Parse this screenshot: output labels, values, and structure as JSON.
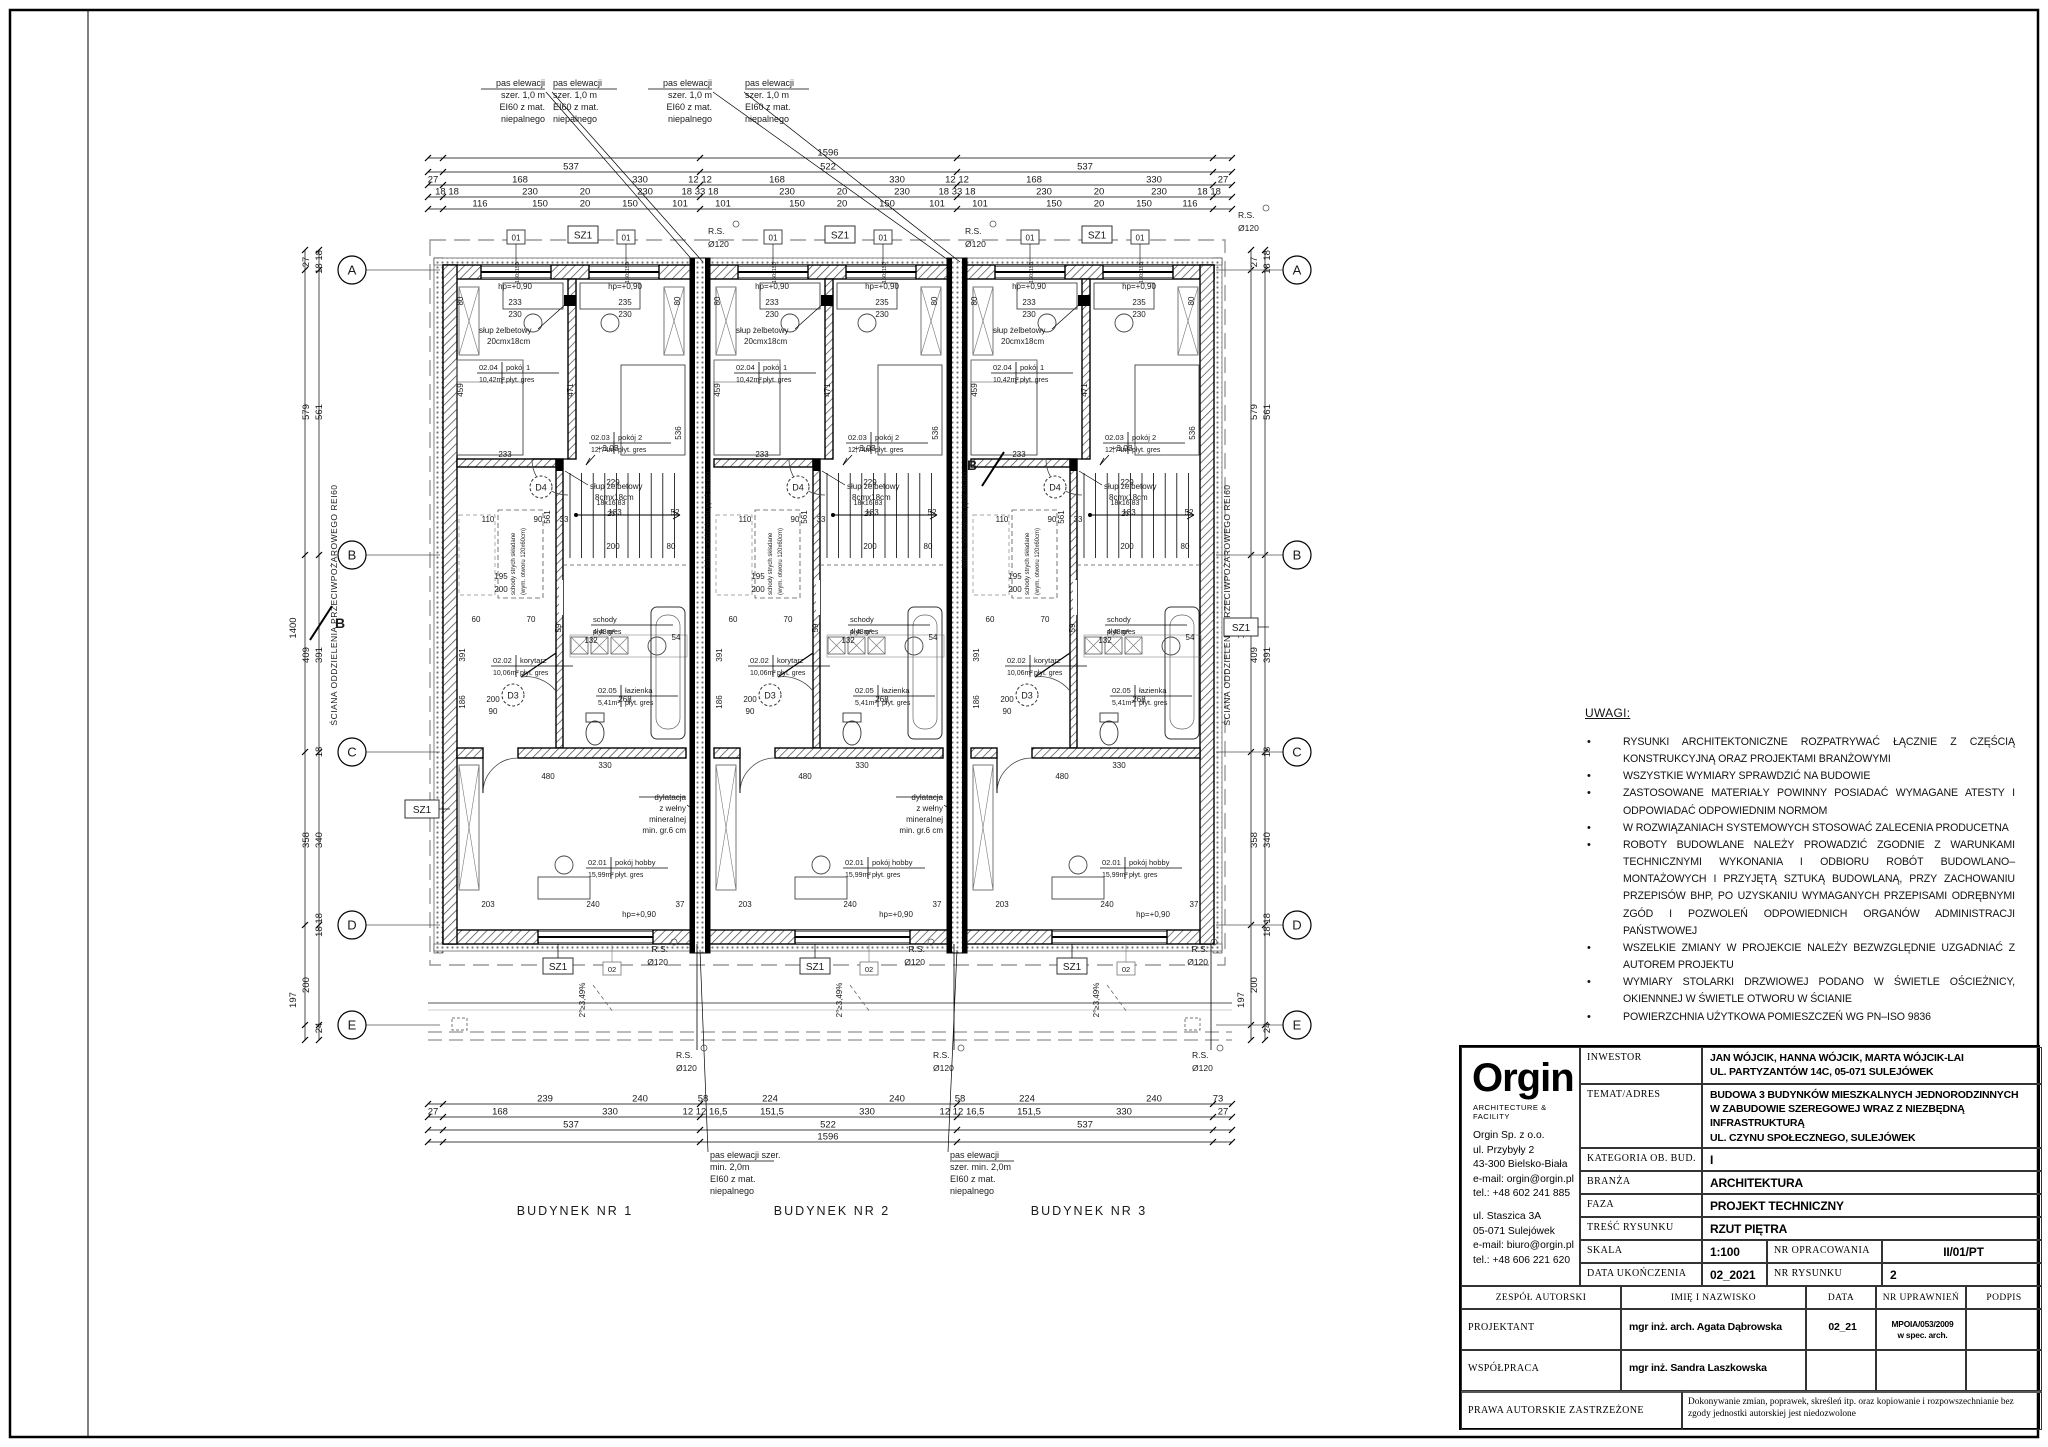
{
  "sheet": {
    "width": 2048,
    "height": 1447
  },
  "plan": {
    "buildings": [
      "BUDYNEK NR 1",
      "BUDYNEK NR 2",
      "BUDYNEK NR 3"
    ],
    "grid_rows": [
      "A",
      "B",
      "C",
      "D",
      "E"
    ],
    "section_marker": "B",
    "notes_top": [
      "pas elewacji",
      "szer. 1,0 m",
      "EI60 z mat.",
      "niepalnego"
    ],
    "notes_bottom_a": [
      "pas elewacji szer.",
      "min. 2,0m",
      "EI60 z mat.",
      "niepalnego"
    ],
    "notes_bottom_b": [
      "pas elewacji",
      "szer. min. 2,0m",
      "EI60 z mat.",
      "niepalnego"
    ],
    "fire_wall_main": "ŚCIANA ODDZIELENIA PRZECIWPOŻAROWEGO REI60",
    "fire_wall_party": "ściana oddzielenia ppoż REI60",
    "tags": {
      "window_top": "01",
      "window_bottom": "02",
      "window_size": "150x150",
      "shaft": "SZ1",
      "rs1": "R.S.",
      "rs2": "Ø120",
      "door1": "D3",
      "door2": "D4",
      "level_top": "hp=+0,90",
      "level_mid": "+3,03",
      "slope": "2°≥3,49%"
    },
    "rooms": {
      "r201": {
        "num": "02.01",
        "name": "pokój hobby",
        "area": "15,99m²",
        "fin": "płyt. gres"
      },
      "r202": {
        "num": "02.02",
        "name": "korytarz",
        "area": "10,06m²",
        "fin": "płyt. gres"
      },
      "r203": {
        "num": "02.03",
        "name": "pokój 2",
        "area": "12,74m²",
        "fin": "płyt. gres"
      },
      "r204": {
        "num": "02.04",
        "name": "pokój 1",
        "area": "10,42m²",
        "fin": "płyt. gres"
      },
      "r205": {
        "num": "02.05",
        "name": "łazienka",
        "area": "5,41m²",
        "fin": "płyt. gres"
      },
      "schody": {
        "name": "schody",
        "area": "4,48m²",
        "fin": "płyt. gres"
      }
    },
    "stair_note": [
      "18x16,83",
      "25"
    ],
    "col1": [
      "słup żelbetowy",
      "20cmx18cm"
    ],
    "col2": [
      "słup żelbetowy",
      "8cmx18cm"
    ],
    "attic": [
      "schody strych składane",
      "(wym. otworu 120x60cm)"
    ],
    "dylatacja": [
      "dylatacja",
      "z wełny",
      "mineralnej",
      "min. gr.6 cm"
    ],
    "dims": {
      "top": [
        {
          "y": 158,
          "items": [
            {
              "x": 828,
              "t": "1596"
            }
          ]
        },
        {
          "y": 172,
          "items": [
            {
              "x": 571,
              "t": "537"
            },
            {
              "x": 828,
              "t": "522"
            },
            {
              "x": 1085,
              "t": "537"
            }
          ]
        },
        {
          "y": 185,
          "items": [
            {
              "x": 433,
              "t": "27"
            },
            {
              "x": 520,
              "t": "168"
            },
            {
              "x": 640,
              "t": "330"
            },
            {
              "x": 700,
              "t": "12 12"
            },
            {
              "x": 777,
              "t": "168"
            },
            {
              "x": 897,
              "t": "330"
            },
            {
              "x": 957,
              "t": "12 12"
            },
            {
              "x": 1034,
              "t": "168"
            },
            {
              "x": 1154,
              "t": "330"
            },
            {
              "x": 1223,
              "t": "27"
            }
          ]
        },
        {
          "y": 197,
          "items": [
            {
              "x": 447,
              "t": "18 18"
            },
            {
              "x": 530,
              "t": "230"
            },
            {
              "x": 585,
              "t": "20"
            },
            {
              "x": 645,
              "t": "230"
            },
            {
              "x": 700,
              "t": "18 33 18"
            },
            {
              "x": 787,
              "t": "230"
            },
            {
              "x": 842,
              "t": "20"
            },
            {
              "x": 902,
              "t": "230"
            },
            {
              "x": 957,
              "t": "18 33 18"
            },
            {
              "x": 1044,
              "t": "230"
            },
            {
              "x": 1099,
              "t": "20"
            },
            {
              "x": 1159,
              "t": "230"
            },
            {
              "x": 1209,
              "t": "18 18"
            }
          ]
        },
        {
          "y": 209,
          "items": [
            {
              "x": 480,
              "t": "116"
            },
            {
              "x": 540,
              "t": "150"
            },
            {
              "x": 585,
              "t": "20"
            },
            {
              "x": 630,
              "t": "150"
            },
            {
              "x": 680,
              "t": "101"
            },
            {
              "x": 723,
              "t": "101"
            },
            {
              "x": 797,
              "t": "150"
            },
            {
              "x": 842,
              "t": "20"
            },
            {
              "x": 887,
              "t": "150"
            },
            {
              "x": 937,
              "t": "101"
            },
            {
              "x": 980,
              "t": "101"
            },
            {
              "x": 1054,
              "t": "150"
            },
            {
              "x": 1099,
              "t": "20"
            },
            {
              "x": 1144,
              "t": "150"
            },
            {
              "x": 1190,
              "t": "116"
            }
          ]
        }
      ],
      "bottom": [
        {
          "y": 1104,
          "items": [
            {
              "x": 545,
              "t": "239"
            },
            {
              "x": 640,
              "t": "240"
            },
            {
              "x": 703,
              "t": "58"
            },
            {
              "x": 770,
              "t": "224"
            },
            {
              "x": 897,
              "t": "240"
            },
            {
              "x": 960,
              "t": "58"
            },
            {
              "x": 1027,
              "t": "224"
            },
            {
              "x": 1154,
              "t": "240"
            },
            {
              "x": 1218,
              "t": "73"
            }
          ]
        },
        {
          "y": 1117,
          "items": [
            {
              "x": 433,
              "t": "27"
            },
            {
              "x": 500,
              "t": "168"
            },
            {
              "x": 610,
              "t": "330"
            },
            {
              "x": 705,
              "t": "12 12 16,5"
            },
            {
              "x": 772,
              "t": "151,5"
            },
            {
              "x": 867,
              "t": "330"
            },
            {
              "x": 962,
              "t": "12 12 16,5"
            },
            {
              "x": 1029,
              "t": "151,5"
            },
            {
              "x": 1124,
              "t": "330"
            },
            {
              "x": 1223,
              "t": "27"
            }
          ]
        },
        {
          "y": 1130,
          "items": [
            {
              "x": 571,
              "t": "537"
            },
            {
              "x": 828,
              "t": "522"
            },
            {
              "x": 1085,
              "t": "537"
            }
          ]
        },
        {
          "y": 1142,
          "items": [
            {
              "x": 828,
              "t": "1596"
            }
          ]
        }
      ],
      "left": [
        {
          "x": 296,
          "y": 628,
          "t": "1400"
        },
        {
          "x": 309,
          "y": 412,
          "t": "579"
        },
        {
          "x": 322,
          "y": 412,
          "t": "561"
        },
        {
          "x": 309,
          "y": 262,
          "t": "27"
        },
        {
          "x": 322,
          "y": 262,
          "t": "18 18"
        },
        {
          "x": 309,
          "y": 655,
          "t": "409"
        },
        {
          "x": 322,
          "y": 655,
          "t": "391"
        },
        {
          "x": 322,
          "y": 752,
          "t": "18"
        },
        {
          "x": 309,
          "y": 840,
          "t": "358"
        },
        {
          "x": 322,
          "y": 840,
          "t": "340"
        },
        {
          "x": 322,
          "y": 925,
          "t": "18 18"
        },
        {
          "x": 309,
          "y": 985,
          "t": "200"
        },
        {
          "x": 296,
          "y": 1000,
          "t": "197"
        },
        {
          "x": 322,
          "y": 1028,
          "t": "24"
        }
      ],
      "right": [
        {
          "x": 1244,
          "y": 628,
          "t": "1400"
        },
        {
          "x": 1257,
          "y": 412,
          "t": "579"
        },
        {
          "x": 1270,
          "y": 412,
          "t": "561"
        },
        {
          "x": 1257,
          "y": 262,
          "t": "27"
        },
        {
          "x": 1270,
          "y": 262,
          "t": "18 18"
        },
        {
          "x": 1257,
          "y": 655,
          "t": "409"
        },
        {
          "x": 1270,
          "y": 655,
          "t": "391"
        },
        {
          "x": 1270,
          "y": 752,
          "t": "18"
        },
        {
          "x": 1257,
          "y": 840,
          "t": "358"
        },
        {
          "x": 1270,
          "y": 840,
          "t": "340"
        },
        {
          "x": 1270,
          "y": 925,
          "t": "18 18"
        },
        {
          "x": 1257,
          "y": 985,
          "t": "200"
        },
        {
          "x": 1244,
          "y": 1000,
          "t": "197"
        },
        {
          "x": 1270,
          "y": 1028,
          "t": "24"
        }
      ],
      "unit": [
        {
          "dx": 72,
          "dy": 40,
          "t": "233"
        },
        {
          "dx": 182,
          "dy": 40,
          "t": "235"
        },
        {
          "dx": 72,
          "dy": 52,
          "t": "230"
        },
        {
          "dx": 182,
          "dy": 52,
          "t": "230"
        },
        {
          "dx": 20,
          "dy": 36,
          "t": "80",
          "rot": 1
        },
        {
          "dx": 237,
          "dy": 36,
          "t": "80",
          "rot": 1
        },
        {
          "dx": 20,
          "dy": 125,
          "t": "459",
          "rot": 1
        },
        {
          "dx": 130,
          "dy": 125,
          "t": "471",
          "rot": 1
        },
        {
          "dx": 238,
          "dy": 168,
          "t": "536",
          "rot": 1
        },
        {
          "dx": 45,
          "dy": 257,
          "t": "110"
        },
        {
          "dx": 95,
          "dy": 257,
          "t": "90"
        },
        {
          "dx": 121,
          "dy": 257,
          "t": "33"
        },
        {
          "dx": 107,
          "dy": 252,
          "t": "561",
          "rot": 1
        },
        {
          "dx": 62,
          "dy": 192,
          "t": "233"
        },
        {
          "dx": 170,
          "dy": 220,
          "t": "229"
        },
        {
          "dx": 58,
          "dy": 314,
          "t": "195"
        },
        {
          "dx": 58,
          "dy": 327,
          "t": "200"
        },
        {
          "dx": 33,
          "dy": 357,
          "t": "60"
        },
        {
          "dx": 88,
          "dy": 357,
          "t": "70"
        },
        {
          "dx": 22,
          "dy": 390,
          "t": "391",
          "rot": 1
        },
        {
          "dx": 22,
          "dy": 437,
          "t": "186",
          "rot": 1
        },
        {
          "dx": 50,
          "dy": 437,
          "t": "200"
        },
        {
          "dx": 50,
          "dy": 449,
          "t": "90"
        },
        {
          "dx": 148,
          "dy": 378,
          "t": "132"
        },
        {
          "dx": 233,
          "dy": 375,
          "t": "54"
        },
        {
          "dx": 118,
          "dy": 363,
          "t": "59",
          "rot": 1
        },
        {
          "dx": 182,
          "dy": 437,
          "t": "268"
        },
        {
          "dx": 170,
          "dy": 284,
          "t": "200"
        },
        {
          "dx": 228,
          "dy": 284,
          "t": "80"
        },
        {
          "dx": 105,
          "dy": 514,
          "t": "480"
        },
        {
          "dx": 162,
          "dy": 503,
          "t": "330"
        },
        {
          "dx": 45,
          "dy": 642,
          "t": "203"
        },
        {
          "dx": 150,
          "dy": 642,
          "t": "240"
        },
        {
          "dx": 237,
          "dy": 642,
          "t": "37"
        },
        {
          "dx": 172,
          "dy": 250,
          "t": "183"
        },
        {
          "dx": 232,
          "dy": 250,
          "t": "52"
        }
      ]
    }
  },
  "notes": {
    "title": "UWAGI:",
    "items": [
      "RYSUNKI ARCHITEKTONICZNE ROZPATRYWAĆ ŁĄCZNIE Z CZĘŚCIĄ KONSTRUKCYJNĄ ORAZ PROJEKTAMI BRANŻOWYMI",
      "WSZYSTKIE WYMIARY SPRAWDZIĆ NA BUDOWIE",
      "ZASTOSOWANE MATERIAŁY POWINNY POSIADAĆ WYMAGANE ATESTY I ODPOWIADAĆ ODPOWIEDNIM NORMOM",
      "W ROZWIĄZANIACH SYSTEMOWYCH STOSOWAĆ ZALECENIA PRODUCETNA",
      "ROBOTY BUDOWLANE NALEŻY PROWADZIĆ ZGODNIE Z WARUNKAMI TECHNICZNYMI WYKONANIA I ODBIORU ROBÓT BUDOWLANO–MONTAŻOWYCH I PRZYJĘTĄ SZTUKĄ BUDOWLANĄ, PRZY ZACHOWANIU PRZEPISÓW BHP, PO UZYSKANIU WYMAGANYCH PRZEPISAMI ODRĘBNYMI ZGÓD I POZWOLEŃ ODPOWIEDNICH ORGANÓW ADMINISTRACJI PAŃSTWOWEJ",
      "WSZELKIE ZMIANY W PROJEKCIE NALEŻY BEZWZGLĘDNIE UZGADNIAĆ Z AUTOREM PROJEKTU",
      "WYMIARY STOLARKI DRZWIOWEJ PODANO W ŚWIETLE OŚCIEŻNICY, OKIENNNEJ W ŚWIETLE OTWORU W ŚCIANIE",
      "POWIERZCHNIA UŻYTKOWA POMIESZCZEŃ WG PN–ISO 9836"
    ]
  },
  "titleblock": {
    "logo": {
      "name": "Orgin",
      "sub": "ARCHITECTURE & FACILITY",
      "addr1": "Orgin Sp. z o.o.\nul. Przybyły 2\n43-300 Bielsko-Biała\ne-mail: orgin@orgin.pl\ntel.: +48 602 241 885",
      "addr2": "ul. Staszica 3A\n05-071 Sulejówek\ne-mail: biuro@orgin.pl\ntel.: +48 606 221 620"
    },
    "inwestor_label": "INWESTOR",
    "inwestor": "JAN WÓJCIK, HANNA WÓJCIK, MARTA WÓJCIK-LAI\nUL. PARTYZANTÓW 14C, 05-071 SULEJÓWEK",
    "temat_label": "TEMAT/ADRES",
    "temat": "BUDOWA 3 BUDYNKÓW MIESZKALNYCH JEDNORODZINNYCH\nW ZABUDOWIE SZEREGOWEJ WRAZ Z NIEZBĘDNĄ INFRASTRUKTURĄ\nUL. CZYNU SPOŁECZNEGO, SULEJÓWEK\nDZIAŁKI EWID. NR 35/27,150  OBR. 55 JEDN. EWID. 141215_1",
    "kategoria_label": "KATEGORIA OB. BUD.",
    "kategoria": "I",
    "branza_label": "BRANŻA",
    "branza": "ARCHITEKTURA",
    "faza_label": "FAZA",
    "faza": "PROJEKT TECHNICZNY",
    "tresc_label": "TREŚĆ RYSUNKU",
    "tresc": "RZUT PIĘTRA",
    "skala_label": "SKALA",
    "skala": "1:100",
    "nr_oprac_label": "NR OPRACOWANIA",
    "nr_oprac": "II/01/PT",
    "data_label": "DATA UKOŃCZENIA",
    "data": "02_2021",
    "nr_rys_label": "NR RYSUNKU",
    "nr_rys": "2",
    "zespol_label": "ZESPÓŁ  AUTORSKI",
    "imie_label": "IMIĘ I NAZWISKO",
    "data_hdr": "DATA",
    "nr_upr_label": "NR UPRAWNIEŃ",
    "podpis_label": "PODPIS",
    "projektant_label": "PROJEKTANT",
    "projektant_name": "mgr inż. arch. Agata Dąbrowska",
    "projektant_data": "02_21",
    "projektant_upr": "MPOIA/053/2009\nw spec. arch.",
    "wspolpraca_label": "WSPÓŁPRACA",
    "wspolpraca_name": "mgr inż. Sandra Laszkowska",
    "prawa_label": "PRAWA  AUTORSKIE  ZASTRZEŻONE",
    "prawa_text": "Dokonywanie zmian, poprawek, skreśleń itp. oraz kopiowanie i rozpowszechnianie bez zgody jednostki autorskiej jest niedozwolone"
  }
}
